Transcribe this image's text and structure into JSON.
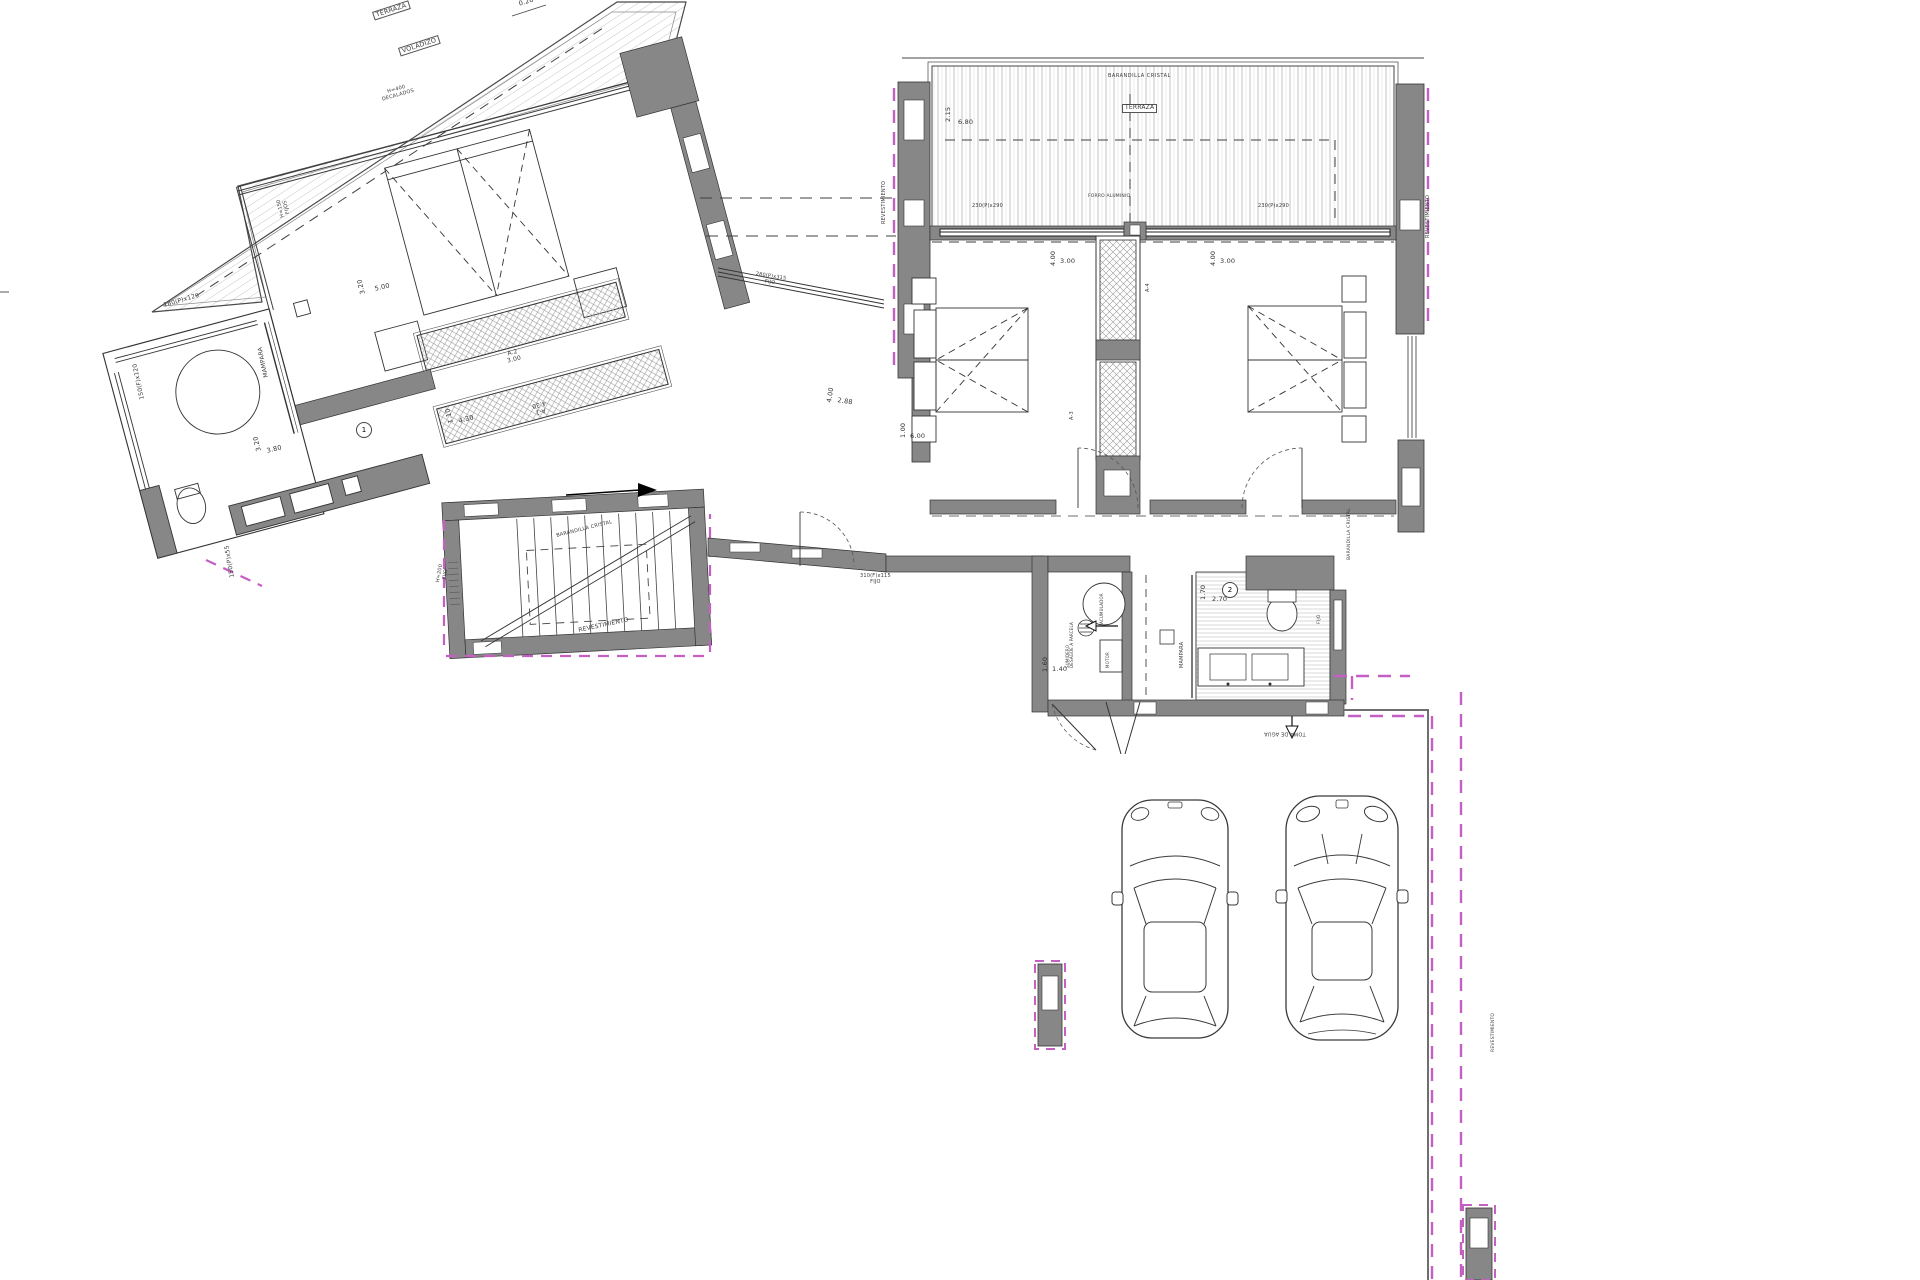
{
  "doc_type": "architectural-floor-plan",
  "colors": {
    "wall": "#878787",
    "line": "#2a2a2a",
    "hatch": "#b0b0b0",
    "magenta": "#c45fc4"
  },
  "labels": {
    "terraza_left": "TERRAZA",
    "voladizo": "VOLADIZO",
    "decalados_l1": "H=400",
    "decalados_l2": "DECALADOS",
    "fijos150_l1": "H=150",
    "fijos150_l2": "FIJOS",
    "win180": "180(P)x120",
    "win150": "150(F)x120",
    "win150p55": "150(P)x55",
    "mampara_left": "MAMPARA",
    "closet_a2": "A.2",
    "closet_a2_len": "3.00",
    "closet_a1": "A-1",
    "closet_a1_len": "4.30",
    "room1": "1",
    "room2": "2",
    "h200_l1": "H=200",
    "h200_l2": "FIJO",
    "barandilla_stair": "BARANDILLA CRISTAL",
    "barandilla_top": "BARANDILLA CRISTAL",
    "barandilla_right": "BARANDILLA CRISTAL",
    "revest_stair": "REVESTIMIENTO",
    "revest_left_r": "REVESTIMIENTO",
    "revest_right_r": "REVESTIMIENTO",
    "revest_pillar": "REVESTIMIENTO",
    "win280_l1": "280(P)x315",
    "win280_l2": "FIJO",
    "win310_l1": "310(F)x115",
    "win310_l2": "FIJO",
    "win230_a": "230(P)x290",
    "win230_b": "230(P)x290",
    "forro": "FORRO ALUMINIO",
    "terraza_right": "TERRAZA",
    "closet_a4": "A-4",
    "closet_a3": "A-3",
    "mampara_right": "MAMPARA",
    "acumulador": "ACUMULADOR",
    "sumidero_l1": "SUMIDERO",
    "sumidero_l2": "DESAGÜE A PARCELA",
    "motor": "MOTOR",
    "fijo_r": "FIJO",
    "toma_agua": "TOMA DE AGUA",
    "dim020": "0.20"
  },
  "dimensions": {
    "bed_left_w": "3.20",
    "bed_left_l": "5.00",
    "dress_w": "1.10",
    "dress_l": "4.30",
    "bath_left_w": "3.20",
    "bath_left_l": "3.80",
    "hall_w": "4.00",
    "hall_l": "2.88",
    "terrace_r_w": "2.15",
    "terrace_r_l": "6.80",
    "bed1_w": "4.00",
    "bed1_l": "3.00",
    "bed2_w": "4.00",
    "bed2_l": "3.00",
    "corridor_w": "1.00",
    "corridor_l": "6.00",
    "bath_r_w": "1.70",
    "bath_r_l": "2.70",
    "util_w": "1.60",
    "util_l": "1.40"
  }
}
